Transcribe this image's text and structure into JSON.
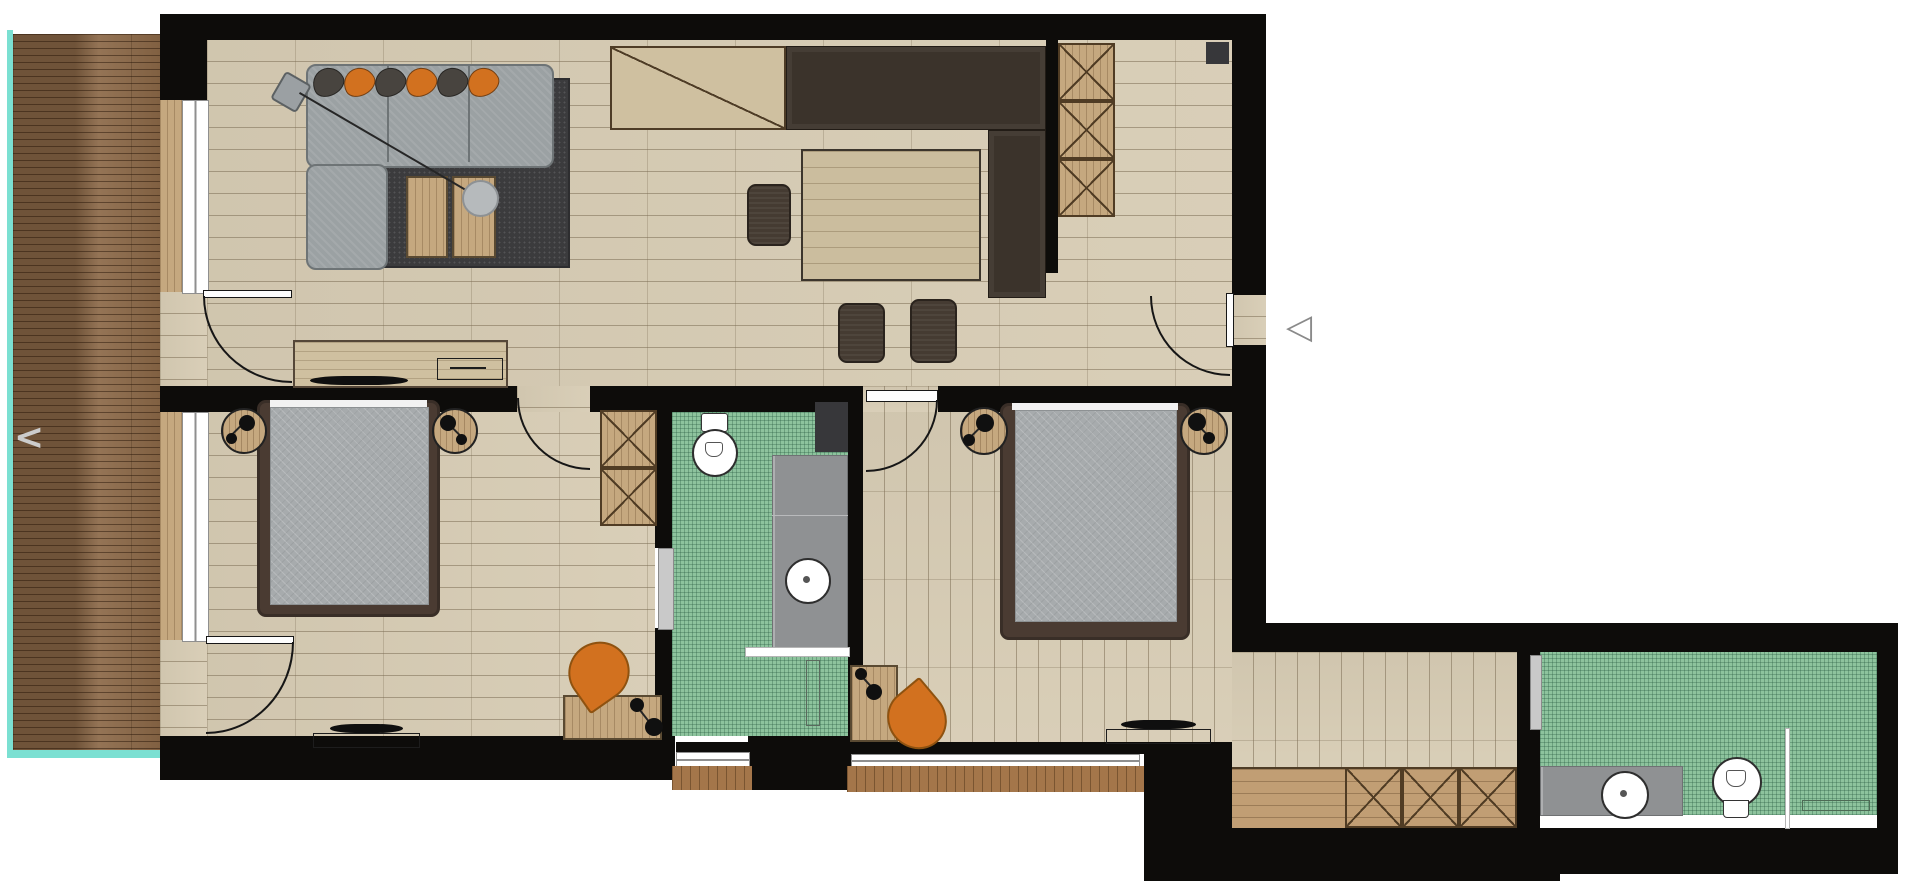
{
  "icons": {
    "prev_arrow": "<",
    "entry_marker": "◁"
  },
  "palette": {
    "wall": "#0d0c0a",
    "floor": "#d7ccb4",
    "deck": "#8b6847",
    "teal": "#7be0d2",
    "mosaic": "#8dc39d",
    "rug": "#3b3b3d",
    "sofa": "#9ba1a3",
    "orange": "#d2711f",
    "counter": "#3b332b",
    "stool": "#453b32",
    "frame": "#4a3b32",
    "mattress": "#a7abad",
    "wood": "#c5a87f",
    "sill": "#a4764a",
    "closet": "#c19e74",
    "vanity": "#8f9193",
    "winframe": "#8f8f8f",
    "chev": "#cccccc",
    "marker": "#8a8a8a"
  },
  "plan": {
    "type": "apartment-floor-plan",
    "rooms": [
      {
        "name": "balcony",
        "features": [
          "wood-decking",
          "teal-edge"
        ]
      },
      {
        "name": "living-dining-room",
        "furniture": [
          "corner-sofa",
          "cushions",
          "rug",
          "coffee-table",
          "floor-lamp",
          "sideboard",
          "tv"
        ]
      },
      {
        "name": "kitchen-area",
        "furniture": [
          "counter",
          "dark-counter-l",
          "dining-table",
          "three-stools",
          "tall-cabinet"
        ]
      },
      {
        "name": "bedroom-1",
        "furniture": [
          "double-bed",
          "two-nightstands",
          "wardrobe",
          "desk",
          "orange-chair",
          "tv"
        ]
      },
      {
        "name": "ensuite-bathroom",
        "fixtures": [
          "toilet",
          "vanity-sink",
          "shower",
          "sliding-door",
          "green-mosaic-floor"
        ]
      },
      {
        "name": "bedroom-2",
        "furniture": [
          "double-bed",
          "two-nightstands",
          "desk",
          "orange-chair",
          "tv"
        ]
      },
      {
        "name": "hallway",
        "furniture": [
          "built-in-closet"
        ]
      },
      {
        "name": "bathroom-2",
        "fixtures": [
          "toilet",
          "vanity-sink",
          "shower-screen",
          "towel-rail",
          "green-mosaic-floor"
        ]
      }
    ],
    "doors": [
      "balcony-door-living",
      "balcony-door-bedroom-1",
      "bedroom-1-door",
      "bedroom-2-door",
      "entry-door",
      "bathroom-sliding-doors"
    ],
    "windows": [
      "living-window-west",
      "bedroom-1-window-west",
      "bathroom-1-window-south",
      "bedroom-2-window-south"
    ]
  }
}
